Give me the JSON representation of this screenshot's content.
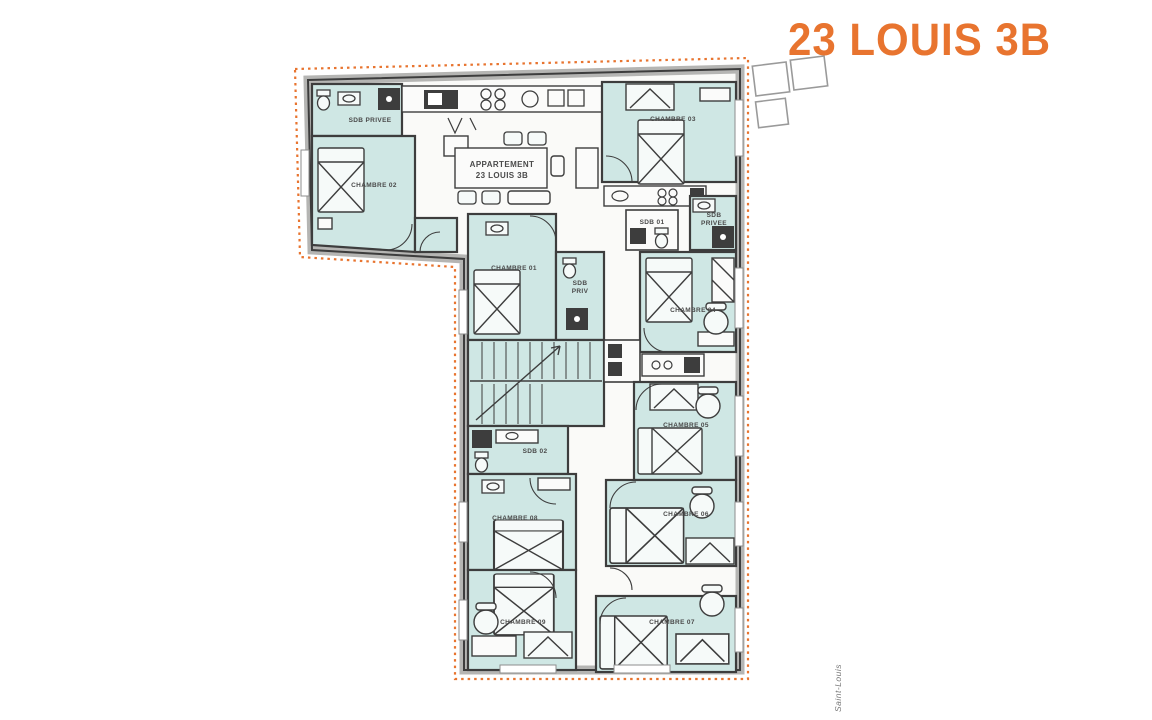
{
  "header": {
    "title": "23 LOUIS 3B"
  },
  "footer": {
    "side_caption": "Saint-Louis"
  },
  "colors": {
    "accent": "#E8742F",
    "room_fill": "#CFE7E4",
    "wall": "#3D3D3D"
  },
  "plan": {
    "apartment_label_line1": "APPARTEMENT",
    "apartment_label_line2": "23 LOUIS 3B",
    "rooms": {
      "chambre01": "CHAMBRE 01",
      "chambre02": "CHAMBRE 02",
      "chambre03": "CHAMBRE 03",
      "chambre04": "CHAMBRE 04",
      "chambre05": "CHAMBRE 05",
      "chambre06": "CHAMBRE 06",
      "chambre07": "CHAMBRE 07",
      "chambre08": "CHAMBRE 08",
      "chambre09": "CHAMBRE 09",
      "sdb01": "SDB 01",
      "sdb02": "SDB 02",
      "sdb_privee": "SDB PRIVEE",
      "sdb": "SDB",
      "privee": "PRIVEE",
      "priv": "PRIV"
    }
  }
}
